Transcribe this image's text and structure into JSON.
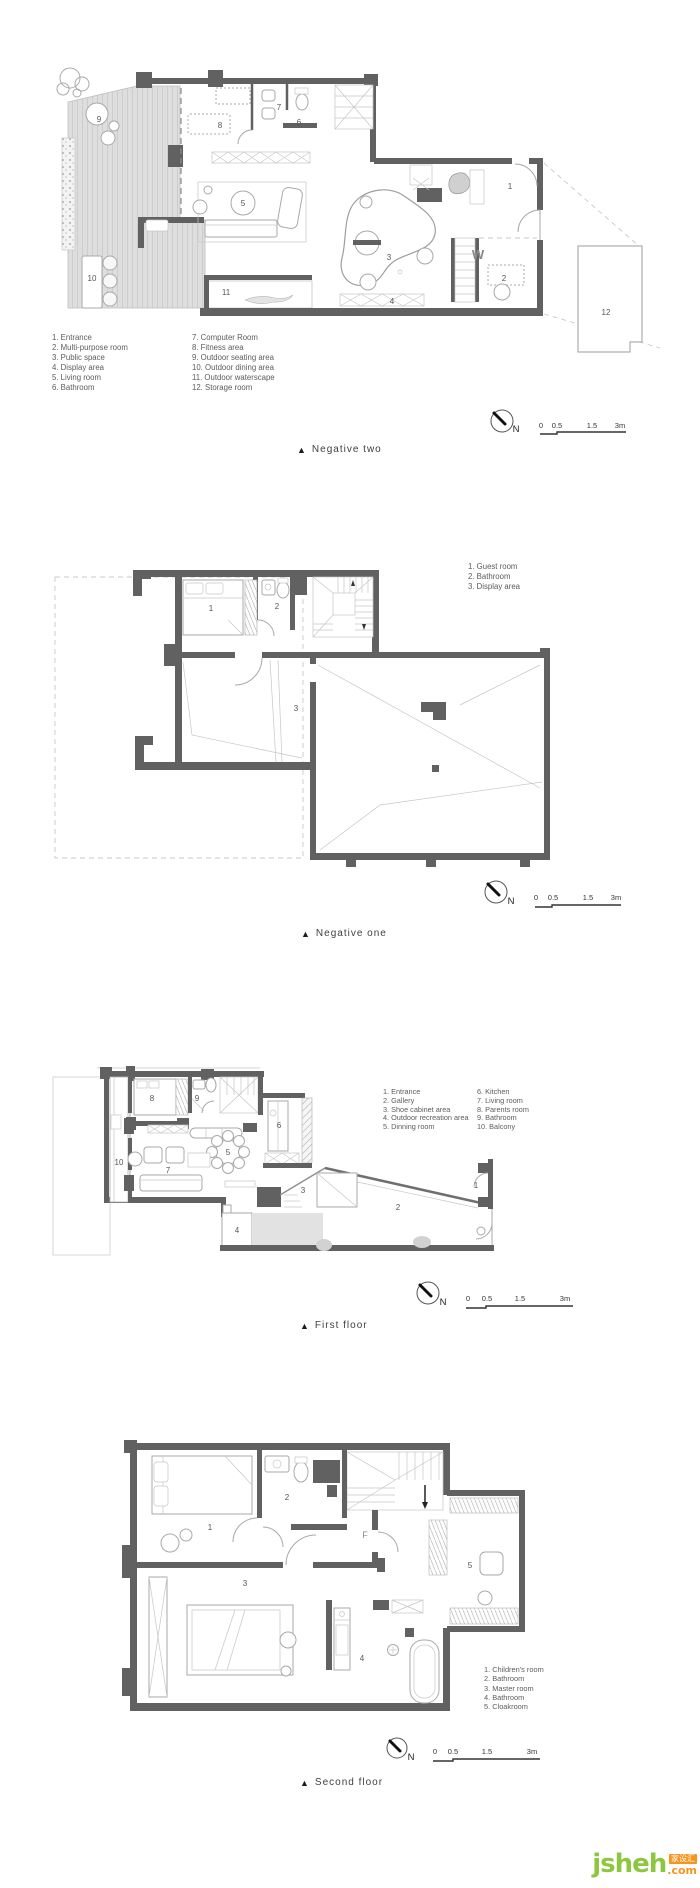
{
  "page": {
    "background": "#ffffff",
    "wall_color": "#616161"
  },
  "floors": [
    {
      "id": "negative-two",
      "marker": "▲",
      "caption": "Negative two",
      "compass": "N",
      "scale": [
        "0",
        "0.5",
        "1.5",
        "3m"
      ],
      "annotation": "W",
      "legend": [
        [
          "1. Entrance",
          "2. Multi-purpose room",
          "3. Public space",
          "4. Display area",
          "5. Living room",
          "6. Bathroom"
        ],
        [
          "7. Computer Room",
          "8. Fitness area",
          "9. Outdoor seating area",
          "10. Outdoor dining area",
          "11. Outdoor waterscape",
          "12. Storage room"
        ]
      ],
      "rooms": [
        "9",
        "10",
        "11",
        "8",
        "7",
        "6",
        "5",
        "3",
        "1",
        "2",
        "4",
        "12"
      ]
    },
    {
      "id": "negative-one",
      "marker": "▲",
      "caption": "Negative one",
      "compass": "N",
      "scale": [
        "0",
        "0.5",
        "1.5",
        "3m"
      ],
      "legend": [
        [
          "1. Guest room",
          "2. Bathroom",
          "3. Display area"
        ]
      ],
      "rooms": [
        "1",
        "2",
        "3"
      ]
    },
    {
      "id": "first-floor",
      "marker": "▲",
      "caption": "First floor",
      "compass": "N",
      "scale": [
        "0",
        "0.5",
        "1.5",
        "3m"
      ],
      "legend": [
        [
          "1. Entrance",
          "2. Gallery",
          "3. Shoe cabinet area",
          "4. Outdoor recreation area",
          "5. Dinning room"
        ],
        [
          "6. Kitchen",
          "7. Living room",
          "8. Parents room",
          "9. Bathroom",
          "10. Balcony"
        ]
      ],
      "rooms": [
        "8",
        "9",
        "6",
        "5",
        "7",
        "10",
        "3",
        "2",
        "1",
        "4"
      ]
    },
    {
      "id": "second-floor",
      "marker": "▲",
      "caption": "Second floor",
      "compass": "N",
      "scale": [
        "0",
        "0.5",
        "1.5",
        "3m"
      ],
      "annotation": "F",
      "legend": [
        [
          "1. Children's room",
          "2. Bathroom",
          "3. Master room",
          "4. Bathroom",
          "5. Cloakroom"
        ]
      ],
      "rooms": [
        "1",
        "2",
        "3",
        "4",
        "5"
      ]
    }
  ],
  "watermark": {
    "name": "jsheh",
    "tld": ".com",
    "badge": "家设汇",
    "green": "#8dc63f",
    "orange": "#f7941d"
  }
}
